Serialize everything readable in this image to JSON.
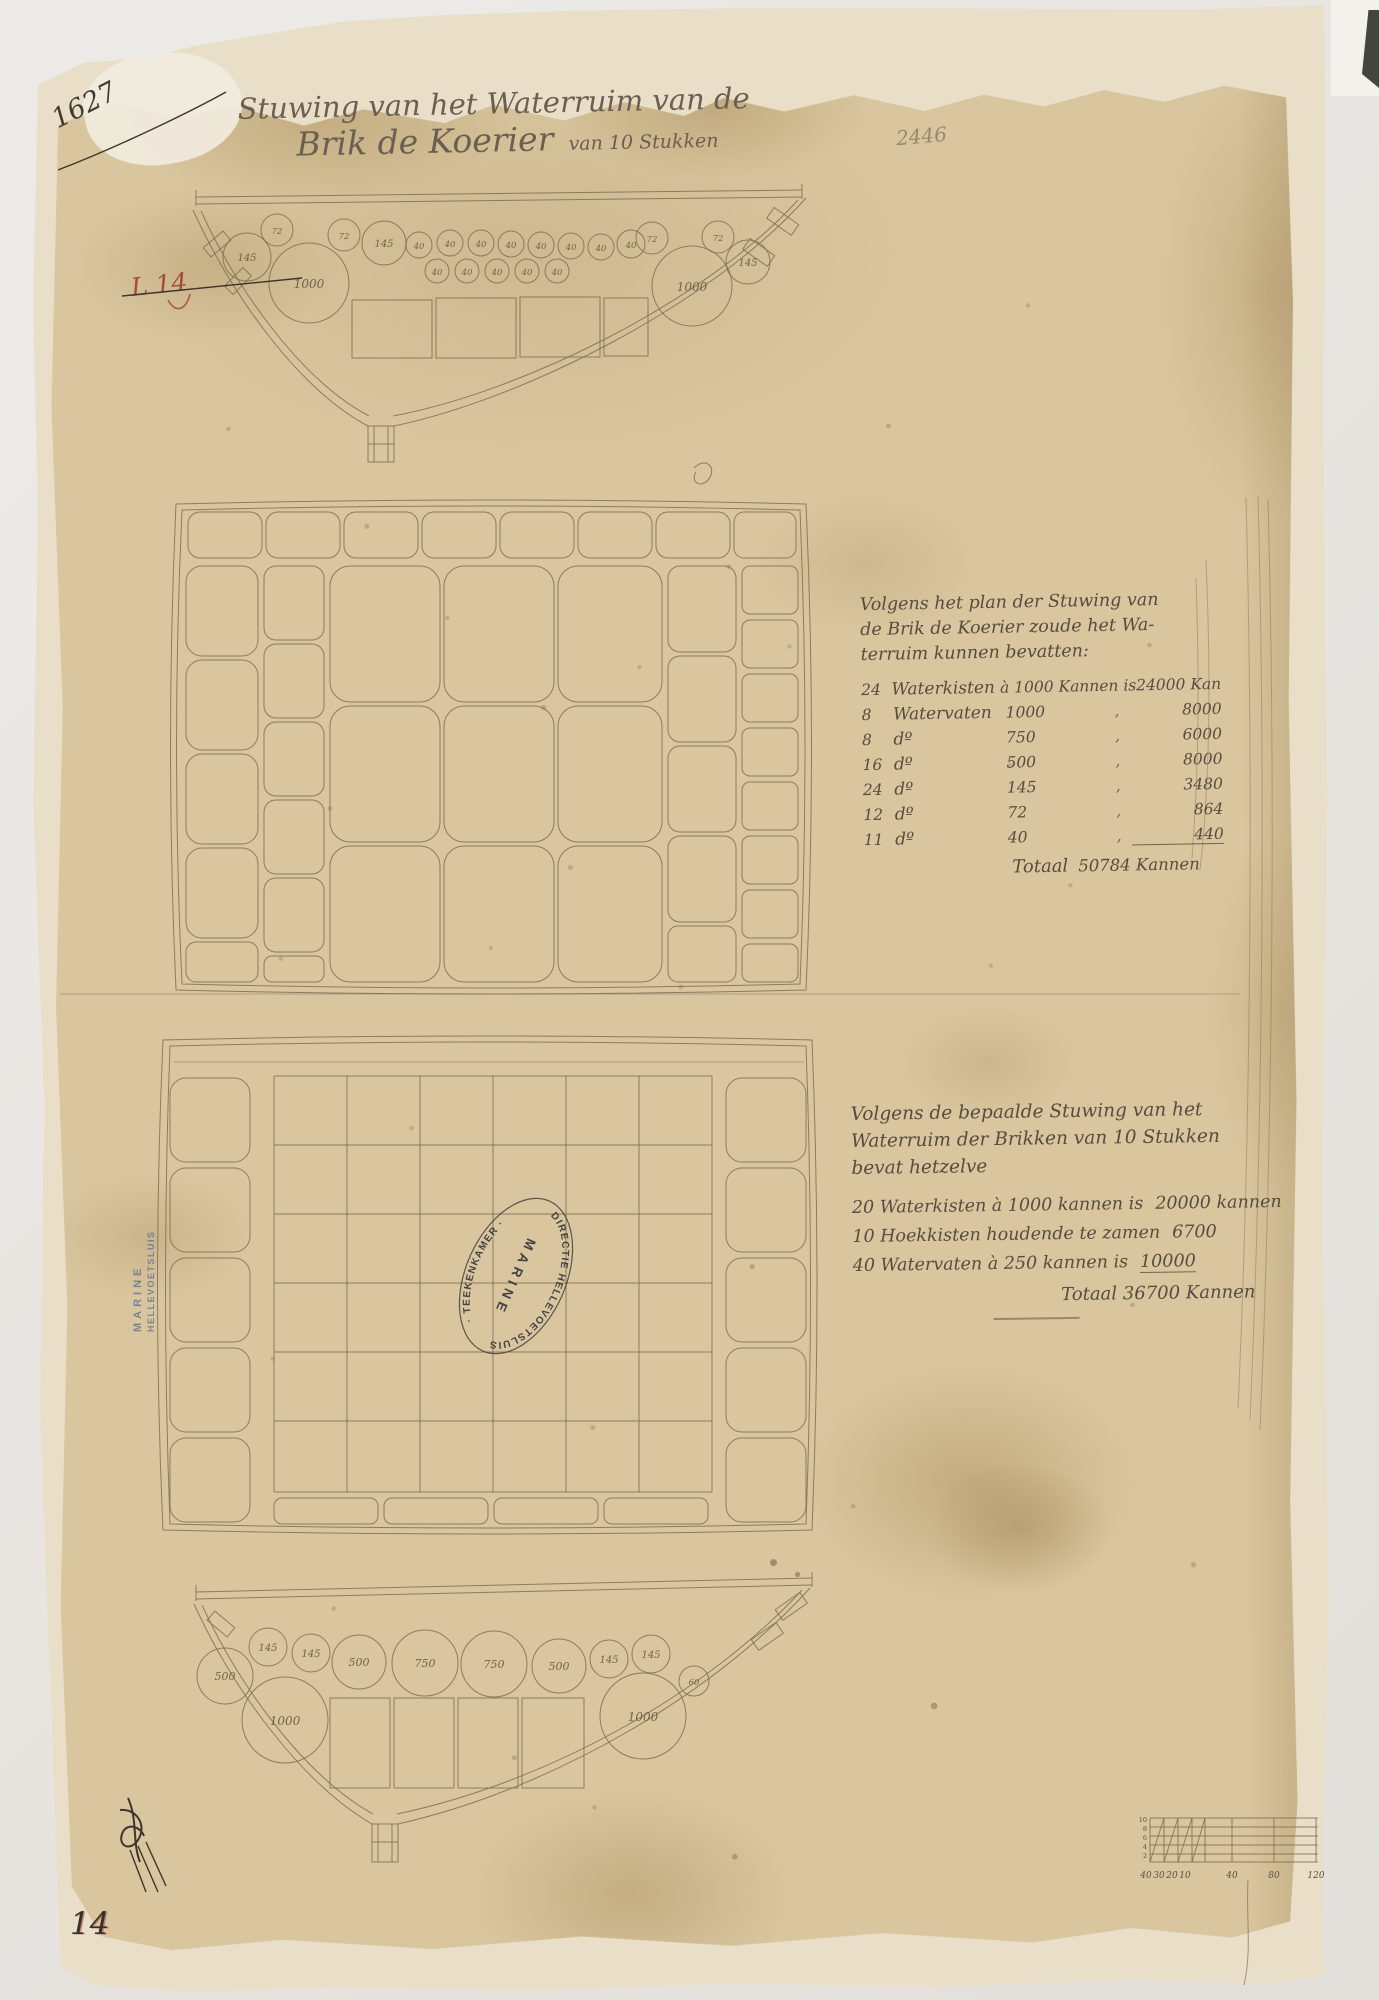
{
  "document": {
    "archive_number": "1627",
    "pencil_number": "2446",
    "red_mark": "L 14",
    "bottom_left_number": "14",
    "title": {
      "line1": "Stuwing van het Waterruim van de",
      "line2_main": "Brik de Koerier",
      "line2_suffix": "van 10 Stukken"
    }
  },
  "note_upper": {
    "intro_lines": [
      "Volgens het plan der Stuwing van",
      "de Brik de Koerier zoude het Wa-",
      "terruim kunnen bevatten:"
    ],
    "rows": [
      {
        "qty": "24",
        "item": "Waterkisten",
        "rate": "à 1000 Kannen is",
        "sep": "",
        "amount": "24000 Kan"
      },
      {
        "qty": "8",
        "item": "Watervaten",
        "rate": "1000",
        "sep": ",",
        "amount": "8000"
      },
      {
        "qty": "8",
        "item": "dº",
        "rate": "750",
        "sep": ",",
        "amount": "6000"
      },
      {
        "qty": "16",
        "item": "dº",
        "rate": "500",
        "sep": ",",
        "amount": "8000"
      },
      {
        "qty": "24",
        "item": "dº",
        "rate": "145",
        "sep": ",",
        "amount": "3480"
      },
      {
        "qty": "12",
        "item": "dº",
        "rate": "72",
        "sep": ",",
        "amount": "864"
      },
      {
        "qty": "11",
        "item": "dº",
        "rate": "40",
        "sep": ",",
        "amount": "440"
      }
    ],
    "total_label": "Totaal",
    "total_value": "50784 Kannen"
  },
  "note_lower": {
    "intro_lines": [
      "Volgens de bepaalde Stuwing van het",
      "Waterruim der Brikken van 10 Stukken",
      "bevat hetzelve"
    ],
    "rows": [
      {
        "text": "20 Waterkisten à 1000 kannen is",
        "value": "20000 kannen"
      },
      {
        "text": "10 Hoekkisten houdende te zamen",
        "value": "6700"
      },
      {
        "text": "40 Watervaten à 250 kannen is",
        "value": "10000"
      }
    ],
    "total_label": "Totaal",
    "total_value": "36700 Kannen"
  },
  "stamps": {
    "oval_arc_top": "DIRECTIE HELLEVOETSLUIS",
    "oval_arc_bottom": "· TEEKENKAMER ·",
    "oval_center": "MARINE",
    "vertical_line1": "MARINE",
    "vertical_line2": "HELLEVOETSLUIS"
  },
  "cross_section_top": {
    "barrel_labels": [
      "145",
      "72",
      "1000",
      "72",
      "145",
      "40",
      "40",
      "40",
      "40",
      "40",
      "40",
      "40",
      "40",
      "40",
      "40",
      "40",
      "40",
      "40",
      "72",
      "72",
      "1000",
      "145"
    ]
  },
  "cross_section_bottom": {
    "barrel_labels": [
      "500",
      "145",
      "145",
      "500",
      "750",
      "750",
      "500",
      "145",
      "145",
      "60",
      "1000",
      "1000"
    ]
  },
  "scale_bar": {
    "sub_labels": [
      "40",
      "30",
      "20",
      "10"
    ],
    "main_labels": [
      "40",
      "80",
      "120"
    ],
    "left_labels": [
      "10",
      "8",
      "6",
      "4",
      "2"
    ]
  },
  "colors": {
    "paper_stain": "#d9c69e",
    "paper_margin": "#e9dfc9",
    "ink": "#564c3f",
    "drawing_line": "#7e6e54",
    "red_ink": "#a34a40",
    "stamp_black": "#30303a",
    "stamp_blue": "#5c6d92"
  }
}
